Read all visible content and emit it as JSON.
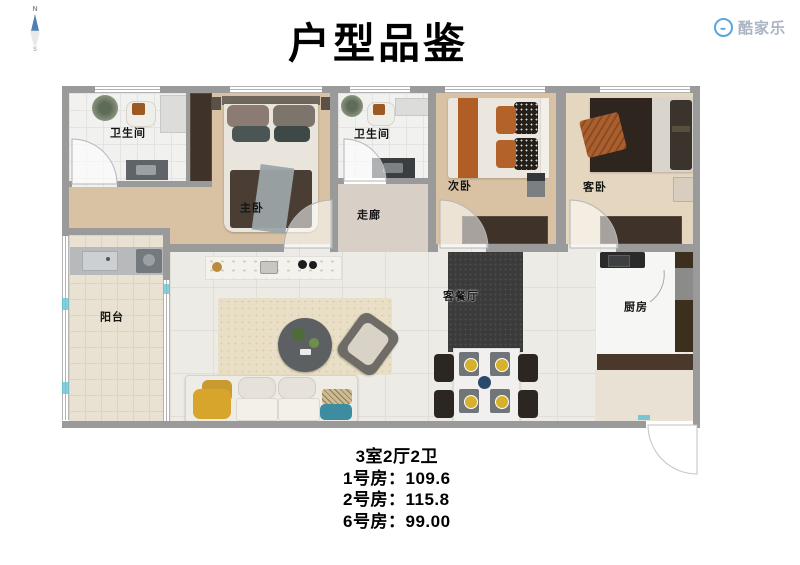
{
  "header": {
    "title": "户型品鉴",
    "brand": "酷家乐"
  },
  "compass": {
    "north": "N",
    "south": "S"
  },
  "rooms": {
    "bathroom1": "卫生间",
    "master": "主卧",
    "bathroom2": "卫生间",
    "corridor": "走廊",
    "bedroom2": "次卧",
    "guest": "客卧",
    "balcony": "阳台",
    "living": "客餐厅",
    "kitchen": "厨房"
  },
  "summary": {
    "layout": "3室2厅2卫",
    "items": [
      {
        "label": "1号房：",
        "value": "109.6"
      },
      {
        "label": "2号房：",
        "value": "115.8"
      },
      {
        "label": "6号房：",
        "value": "99.00"
      }
    ]
  },
  "colors": {
    "brand_blue": "#57a7e0",
    "wall_gray": "#9a9a9a",
    "accent_teal": "#69c4d2",
    "wood": "#d8c2a3"
  },
  "icons": {
    "brand": "smiley-face-icon",
    "compass": "compass-needle-icon"
  }
}
